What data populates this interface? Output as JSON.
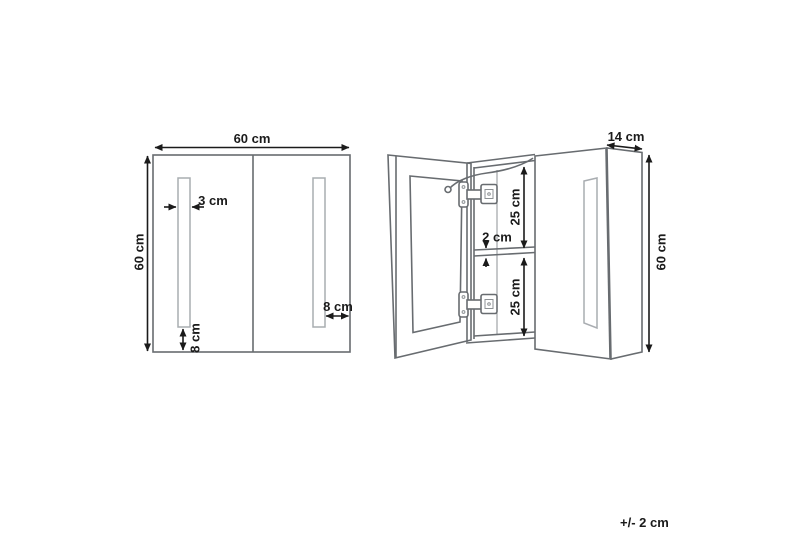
{
  "drawing": {
    "description": "Dimensioned technical drawing of a two-door LED mirror bathroom wall cabinet, front view and open side view",
    "front_view": {
      "width": "60 cm",
      "height": "60 cm",
      "light_strip_width": "3 cm",
      "light_strip_bottom_offset": "8 cm",
      "light_strip_side_offset": "8 cm"
    },
    "open_view": {
      "depth": "14 cm",
      "height": "60 cm",
      "upper_compartment": "25 cm",
      "shelf_thickness": "2 cm",
      "lower_compartment": "25 cm"
    },
    "tolerance": "+/- 2 cm",
    "colors": {
      "outline": "#686c70",
      "light_outline": "#a9adb1",
      "dimension": "#1b1b1b",
      "background": "#ffffff"
    }
  }
}
